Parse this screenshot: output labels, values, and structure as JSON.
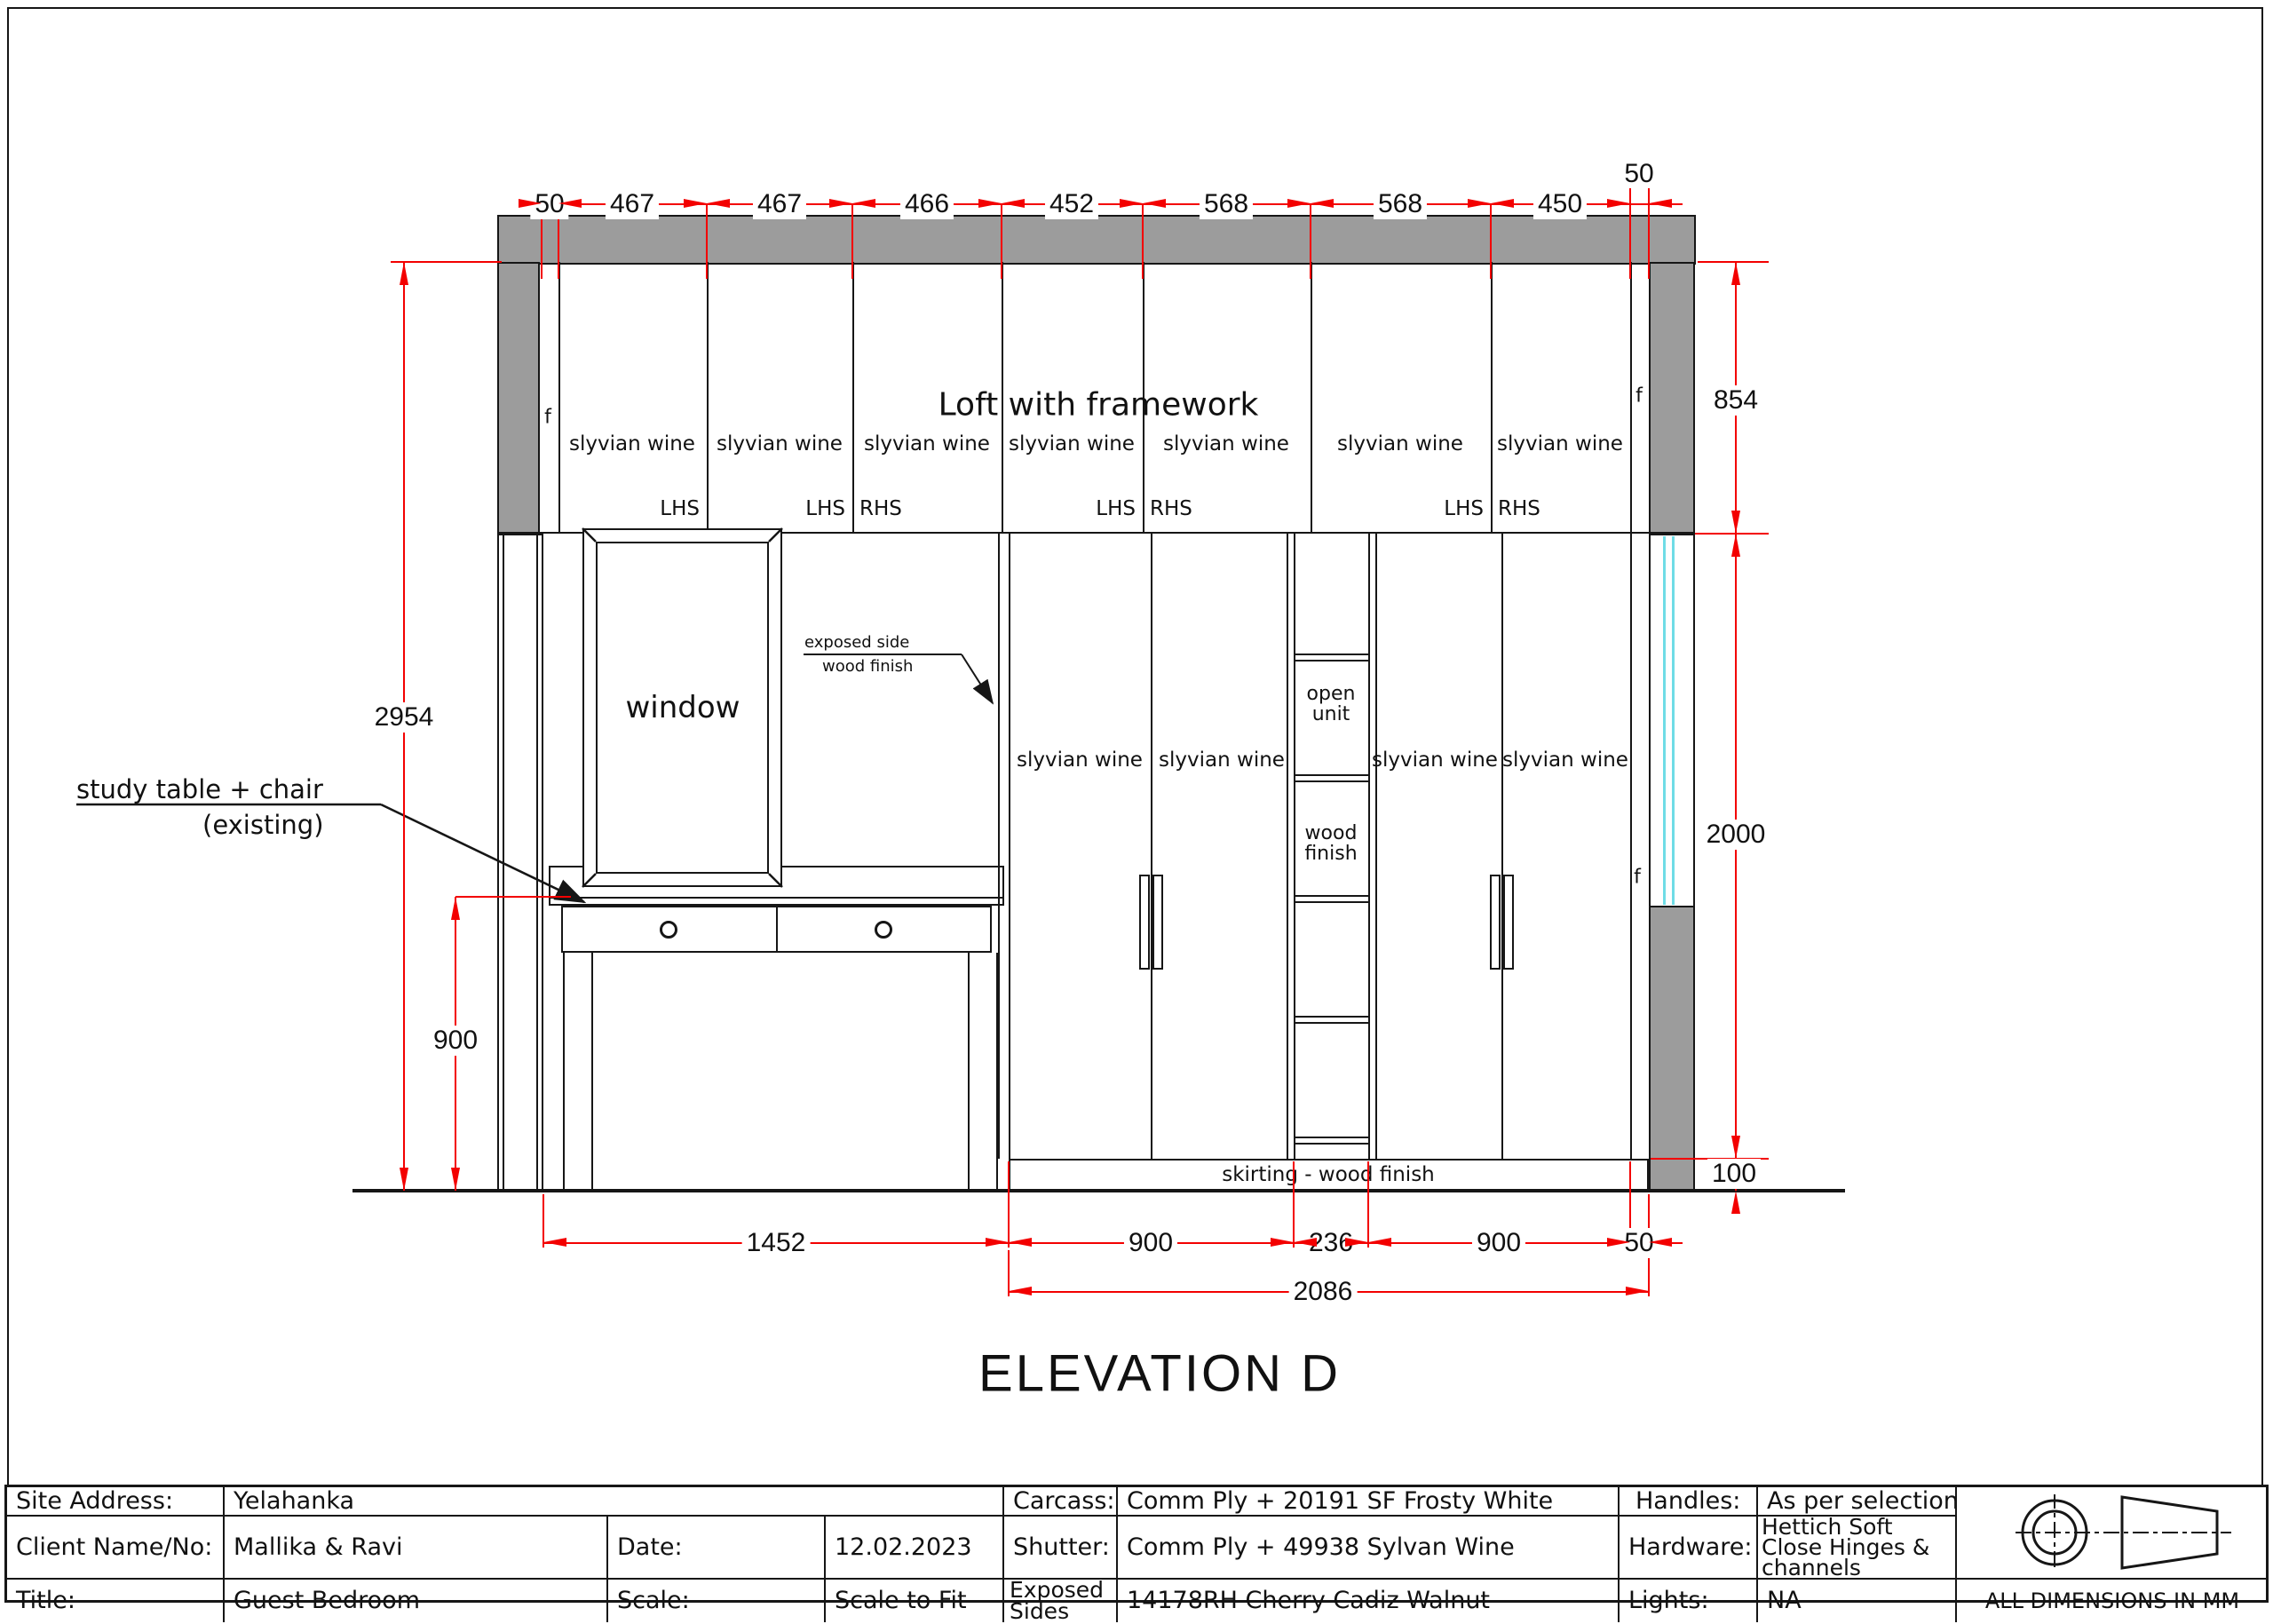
{
  "drawing": {
    "title": "ELEVATION D",
    "top_dims": [
      "50",
      "467",
      "467",
      "466",
      "452",
      "568",
      "568",
      "450",
      "50"
    ],
    "bottom_dims": [
      "1452",
      "900",
      "236",
      "900",
      "50"
    ],
    "overall_width_dim": "2086",
    "height_dims": {
      "overall": "2954",
      "table": "900",
      "loft": "854",
      "shutters": "2000",
      "skirting": "100"
    },
    "loft": {
      "title": "Loft with framework",
      "filler_label": "f",
      "panels": [
        "slyvian wine",
        "slyvian wine",
        "slyvian wine",
        "slyvian wine",
        "slyvian wine",
        "slyvian wine",
        "slyvian wine"
      ],
      "hinges": [
        "LHS",
        "LHS",
        "RHS",
        "LHS",
        "RHS",
        "LHS",
        "RHS"
      ]
    },
    "wardrobe": {
      "shutters": [
        "slyvian wine",
        "slyvian wine",
        "slyvian wine",
        "slyvian wine"
      ],
      "open_unit_label": "open unit",
      "open_unit_finish": "wood finish",
      "filler_label": "f",
      "skirting_label": "skirting - wood finish"
    },
    "window_label": "window",
    "annotations": {
      "study_table_line1": "study table + chair",
      "study_table_line2": "(existing)",
      "exposed_line1": "exposed side",
      "exposed_line2": "wood finish"
    }
  },
  "title_block": {
    "r1": {
      "c1": "Site Address:",
      "c2": "Yelahanka",
      "c5": "Carcass:",
      "c6": "Comm Ply + 20191 SF Frosty White",
      "c7": "Handles:",
      "c8": "As per selection"
    },
    "r2": {
      "c1": "Client Name/No:",
      "c2": "Mallika & Ravi",
      "c3": "Date:",
      "c4": "12.02.2023",
      "c5": "Shutter:",
      "c6": "Comm Ply + 49938 Sylvan Wine",
      "c7": "Hardware:",
      "c8": "Hettich Soft Close Hinges & channels"
    },
    "r3": {
      "c1": "Title:",
      "c2": "Guest Bedroom",
      "c3": "Scale:",
      "c4": "Scale to Fit",
      "c5": "Exposed Sides",
      "c6": "14178RH Cherry Cadiz Walnut",
      "c7": "Lights:",
      "c8": "NA",
      "c9": "ALL DIMENSIONS IN MM"
    }
  },
  "colors": {
    "dimension_red": "#f30000",
    "structure_gray": "#9c9c9c",
    "glass_cyan": "#6fdce6"
  }
}
